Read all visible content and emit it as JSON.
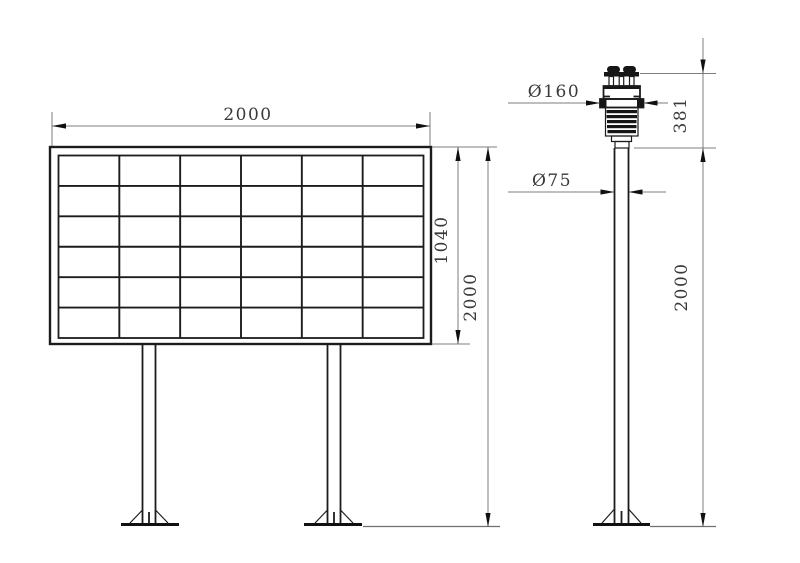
{
  "drawing": {
    "type": "engineering-dimension-drawing",
    "background": "#ffffff",
    "colors": {
      "object_line": "#1c1c1c",
      "dimension_line": "#7d7d7d",
      "arrow": "#101010",
      "text": "#3a3a3a"
    }
  },
  "views": {
    "signboard": {
      "name": "solar panel sign board - front view",
      "grid": {
        "rows": 6,
        "columns": 6
      },
      "dimensions": {
        "width_label": "2000",
        "panel_height_label": "1040",
        "overall_height_label": "2000"
      }
    },
    "sensor_pole": {
      "name": "weather sensor on pole - side view",
      "dimensions": {
        "sensor_diameter_label": "Ø160",
        "pole_diameter_label": "Ø75",
        "sensor_height_label": "381",
        "pole_height_label": "2000"
      }
    }
  }
}
